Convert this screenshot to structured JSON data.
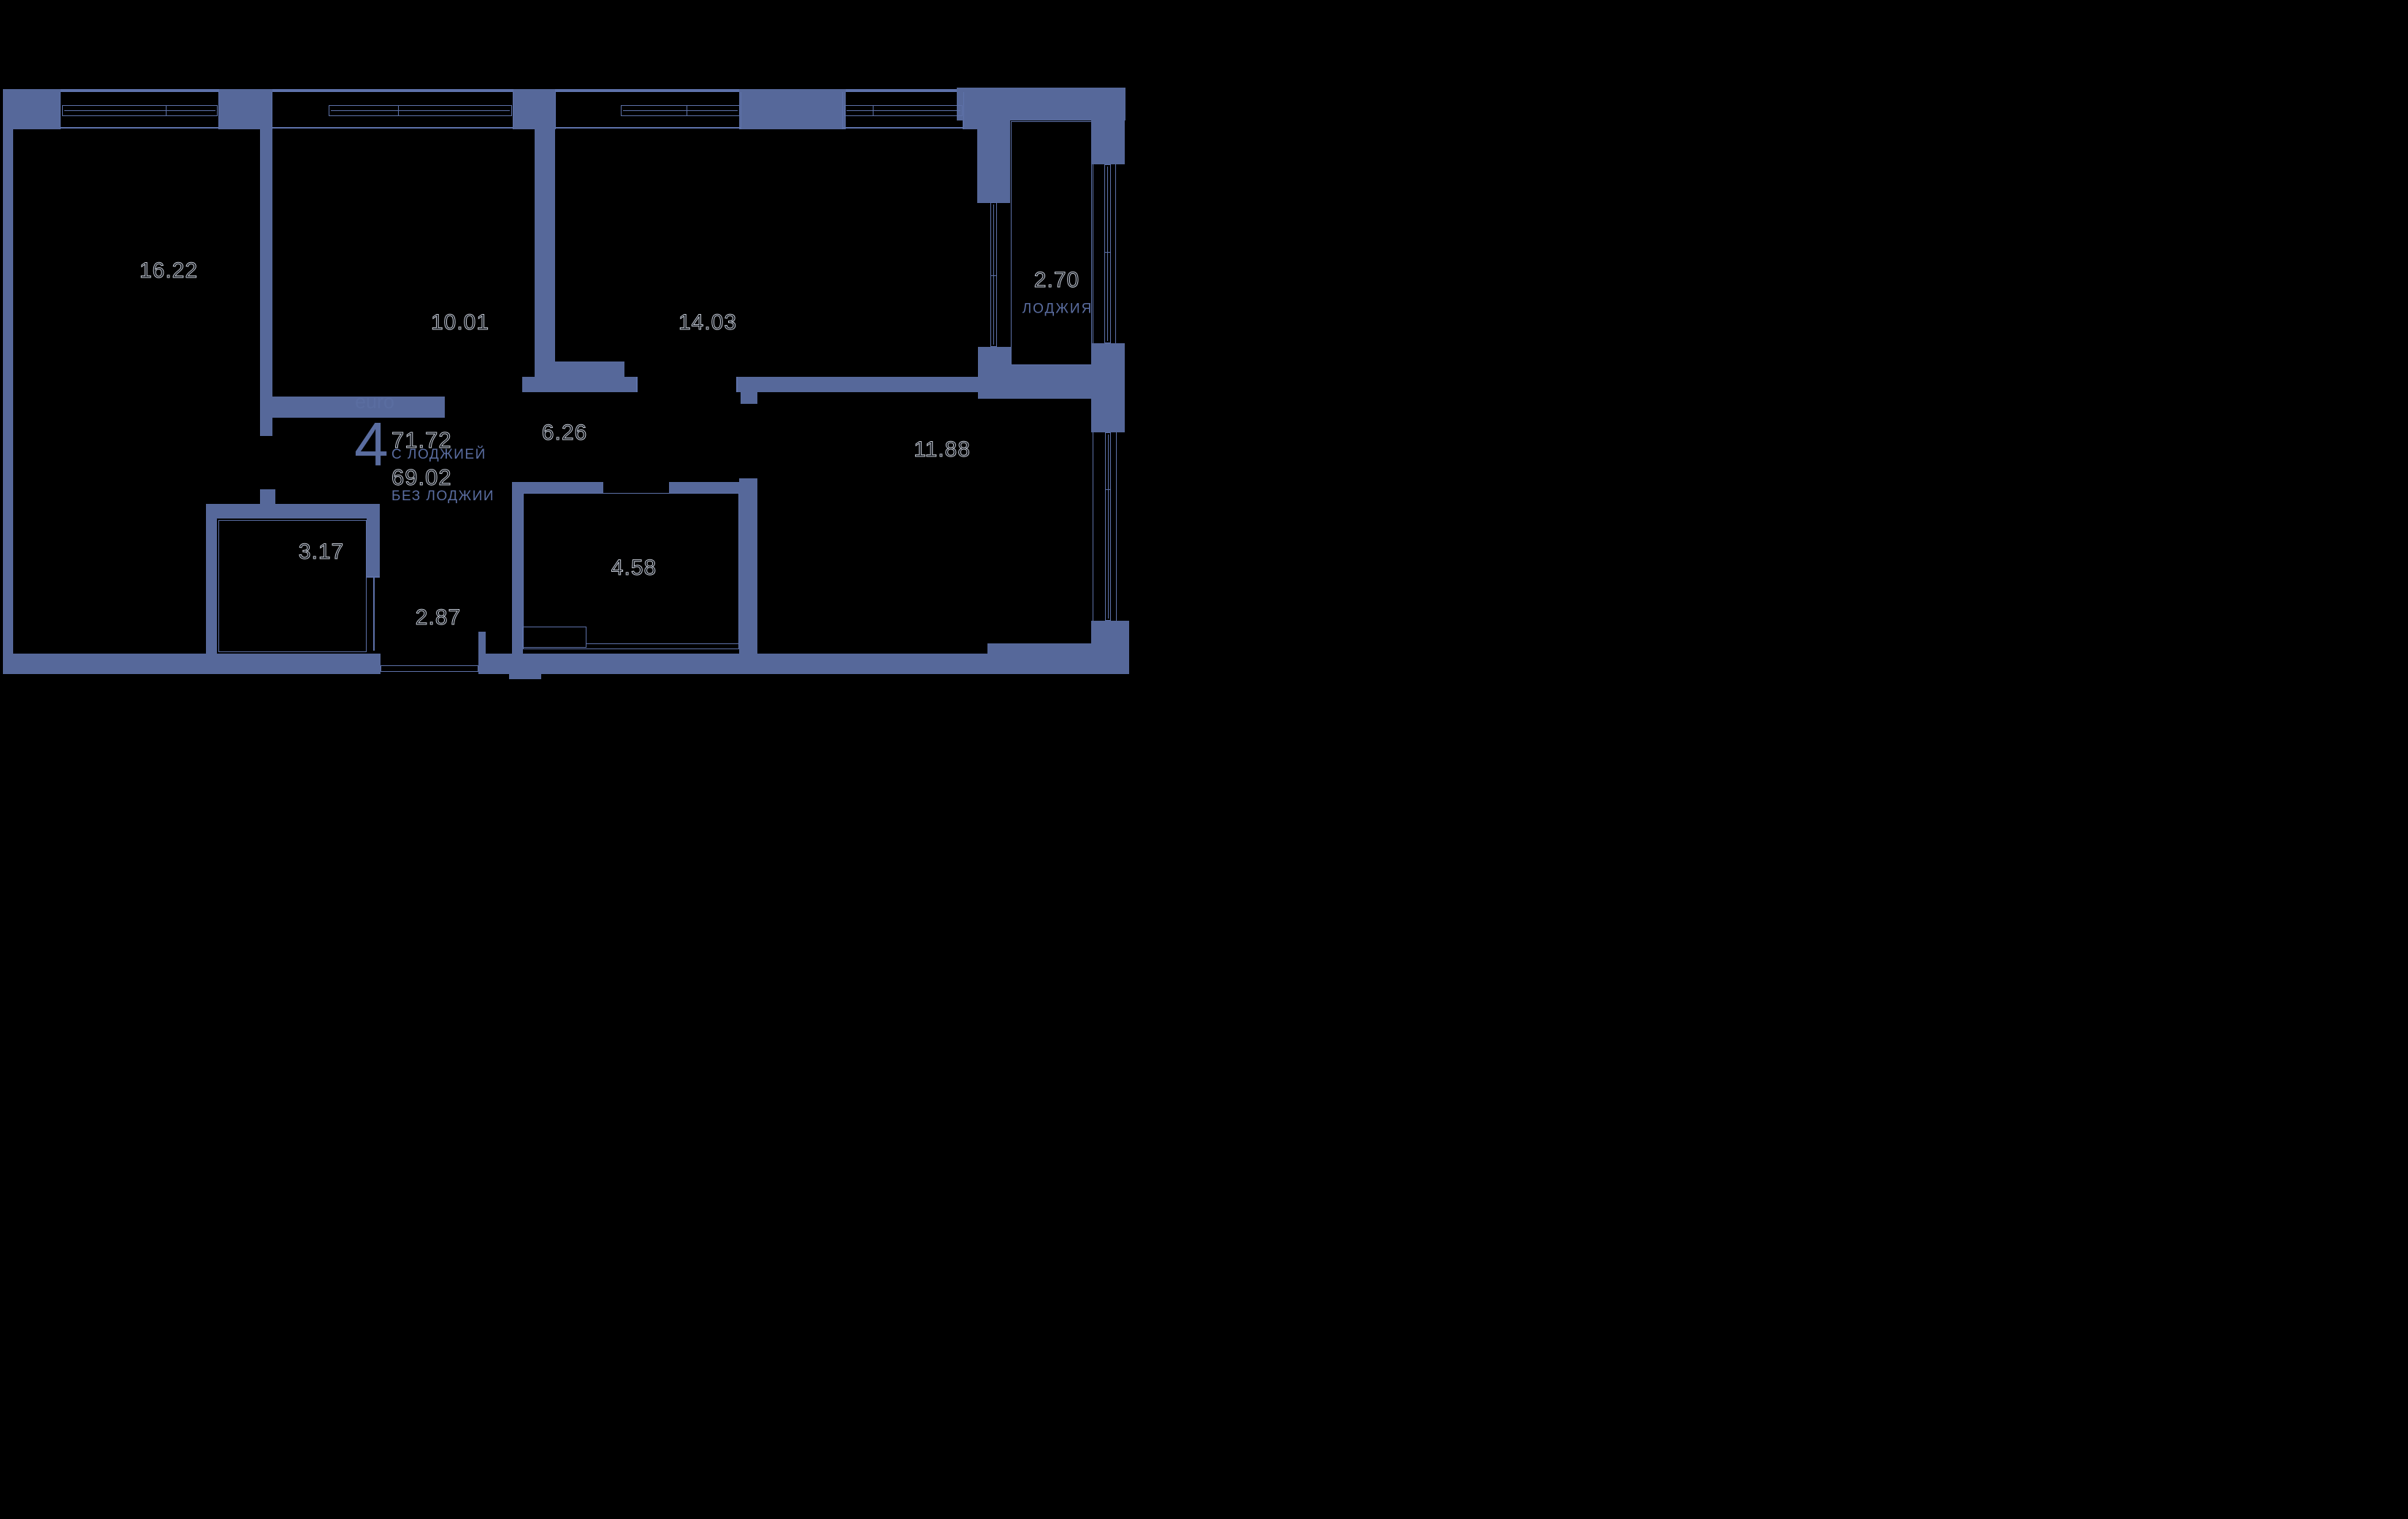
{
  "plan": {
    "summary": {
      "type_label": "euro",
      "rooms_count": "4",
      "area_with_loggia": "71.72",
      "with_loggia_label": "С ЛОДЖИЕЙ",
      "area_without_loggia": "69.02",
      "without_loggia_label": "БЕЗ ЛОДЖИИ"
    },
    "rooms": [
      {
        "id": "living-room",
        "area": "16.22"
      },
      {
        "id": "bedroom-1",
        "area": "10.01"
      },
      {
        "id": "bedroom-2",
        "area": "14.03"
      },
      {
        "id": "corridor",
        "area": "6.26"
      },
      {
        "id": "bedroom-3",
        "area": "11.88"
      },
      {
        "id": "bathroom",
        "area": "3.17"
      },
      {
        "id": "kitchen-niche",
        "area": "4.58"
      },
      {
        "id": "hall",
        "area": "2.87"
      },
      {
        "id": "loggia",
        "area": "2.70",
        "name": "ЛОДЖИЯ"
      }
    ],
    "colors": {
      "wall": "#56689A",
      "thin_line": "#5E72AA",
      "blue_text": "#5A6DA0",
      "number_outline": "#C9CFD9",
      "background": "#000000"
    }
  }
}
